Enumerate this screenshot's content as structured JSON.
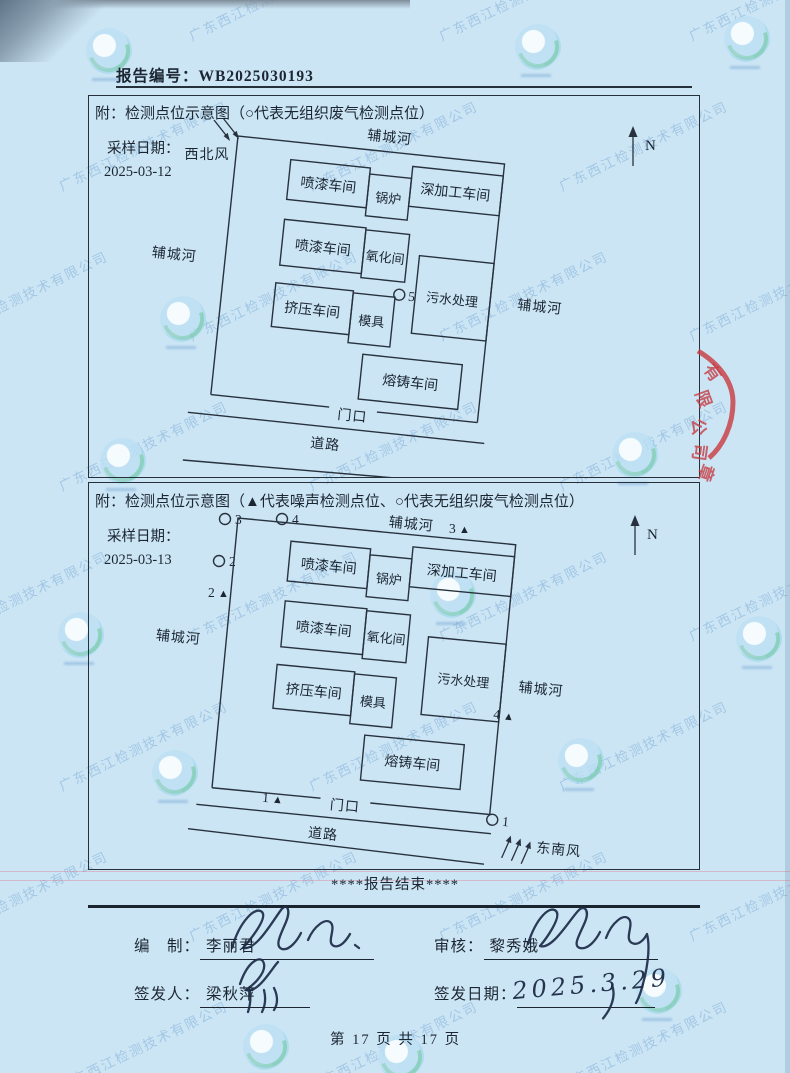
{
  "header": {
    "report_no_label": "报告编号：",
    "report_no": "WB2025030193"
  },
  "diagram1": {
    "title": "附：检测点位示意图（○代表无组织废气检测点位）",
    "sample_date_label": "采样日期：",
    "sample_date": "2025-03-12",
    "wind_label": "西北风",
    "north_label": "N",
    "river_top": "辅城河",
    "river_left": "辅城河",
    "river_right": "辅城河",
    "rooms": {
      "paint_top": "喷漆车间",
      "boiler": "锅炉",
      "deep_processing": "深加工车间",
      "paint_mid": "喷漆车间",
      "oxidation": "氧化间",
      "sewage": "污水处理",
      "extrusion": "挤压车间",
      "mold": "模具",
      "casting": "熔铸车间"
    },
    "gate_label": "门口",
    "road_label": "道路",
    "points": {
      "gas5": "5"
    }
  },
  "diagram2": {
    "title": "附：检测点位示意图（▲代表噪声检测点位、○代表无组织废气检测点位）",
    "sample_date_label": "采样日期：",
    "sample_date": "2025-03-13",
    "wind_label": "东南风",
    "north_label": "N",
    "river_top": "辅城河",
    "river_left": "辅城河",
    "river_right": "辅城河",
    "rooms": {
      "paint_top": "喷漆车间",
      "boiler": "锅炉",
      "deep_processing": "深加工车间",
      "paint_mid": "喷漆车间",
      "oxidation": "氧化间",
      "sewage": "污水处理",
      "extrusion": "挤压车间",
      "mold": "模具",
      "casting": "熔铸车间"
    },
    "gate_label": "门口",
    "road_label": "道路",
    "points": {
      "gas1": "1",
      "gas2": "2",
      "gas3": "3",
      "gas4": "4",
      "noise1": "1",
      "noise2": "2",
      "noise3": "3",
      "noise4": "4"
    }
  },
  "footer": {
    "end_text": "****报告结束****",
    "prepared_label": "编　制：",
    "prepared_by": "李丽君",
    "reviewed_label": "审核：",
    "reviewed_by": "黎秀娥",
    "issuer_label": "签发人：",
    "issuer": "梁秋萍",
    "issue_date_label": "签发日期：",
    "issue_date": "2025.3.29",
    "page_info": "第 17 页 共 17 页"
  },
  "stamp": {
    "visible_chars": [
      "有",
      "限",
      "公",
      "司",
      "章"
    ],
    "color": "#c63a40"
  },
  "watermark": {
    "company": "广东西江检测技术有限公司"
  },
  "colors": {
    "paper": "#cbe5f5",
    "ink": "#1c2632",
    "stamp_red": "#c63a40",
    "watermark_blue": "#6c9ecc",
    "signature_ink": "#1d2b45"
  }
}
